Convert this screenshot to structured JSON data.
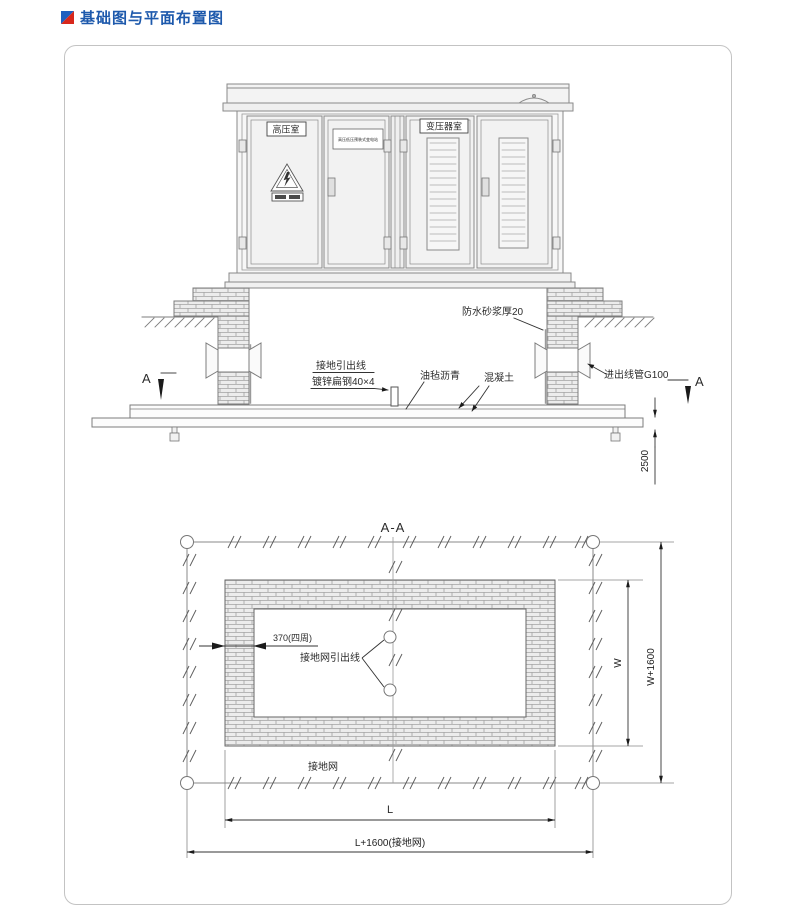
{
  "page": {
    "title": "基础图与平面布置图"
  },
  "colors": {
    "title_blue": "#1d59ac",
    "icon_blue": "#1f5fbf",
    "icon_red": "#d8271c"
  },
  "elevation": {
    "hv_room": "高压室",
    "transformer_room": "变压器室",
    "nameplate": "高压低压预装式变电站",
    "ground_lead": "接地引出线",
    "flat_steel": "镀锌扁钢40×4",
    "asphalt_felt": "油毡沥青",
    "concrete": "混凝土",
    "waterproof_mortar": "防水砂浆厚20",
    "conduit": "进出线管G100",
    "depth_dim": "2500",
    "section_mark": "A"
  },
  "plan": {
    "title": "A-A",
    "wall_thickness_dim": "370(四周)",
    "ground_grid_lead": "接地网引出线",
    "ground_grid": "接地网",
    "dim_w": "W",
    "dim_w_plus": "W+1600",
    "dim_l": "L",
    "dim_l_plus": "L+1600(接地网)"
  }
}
